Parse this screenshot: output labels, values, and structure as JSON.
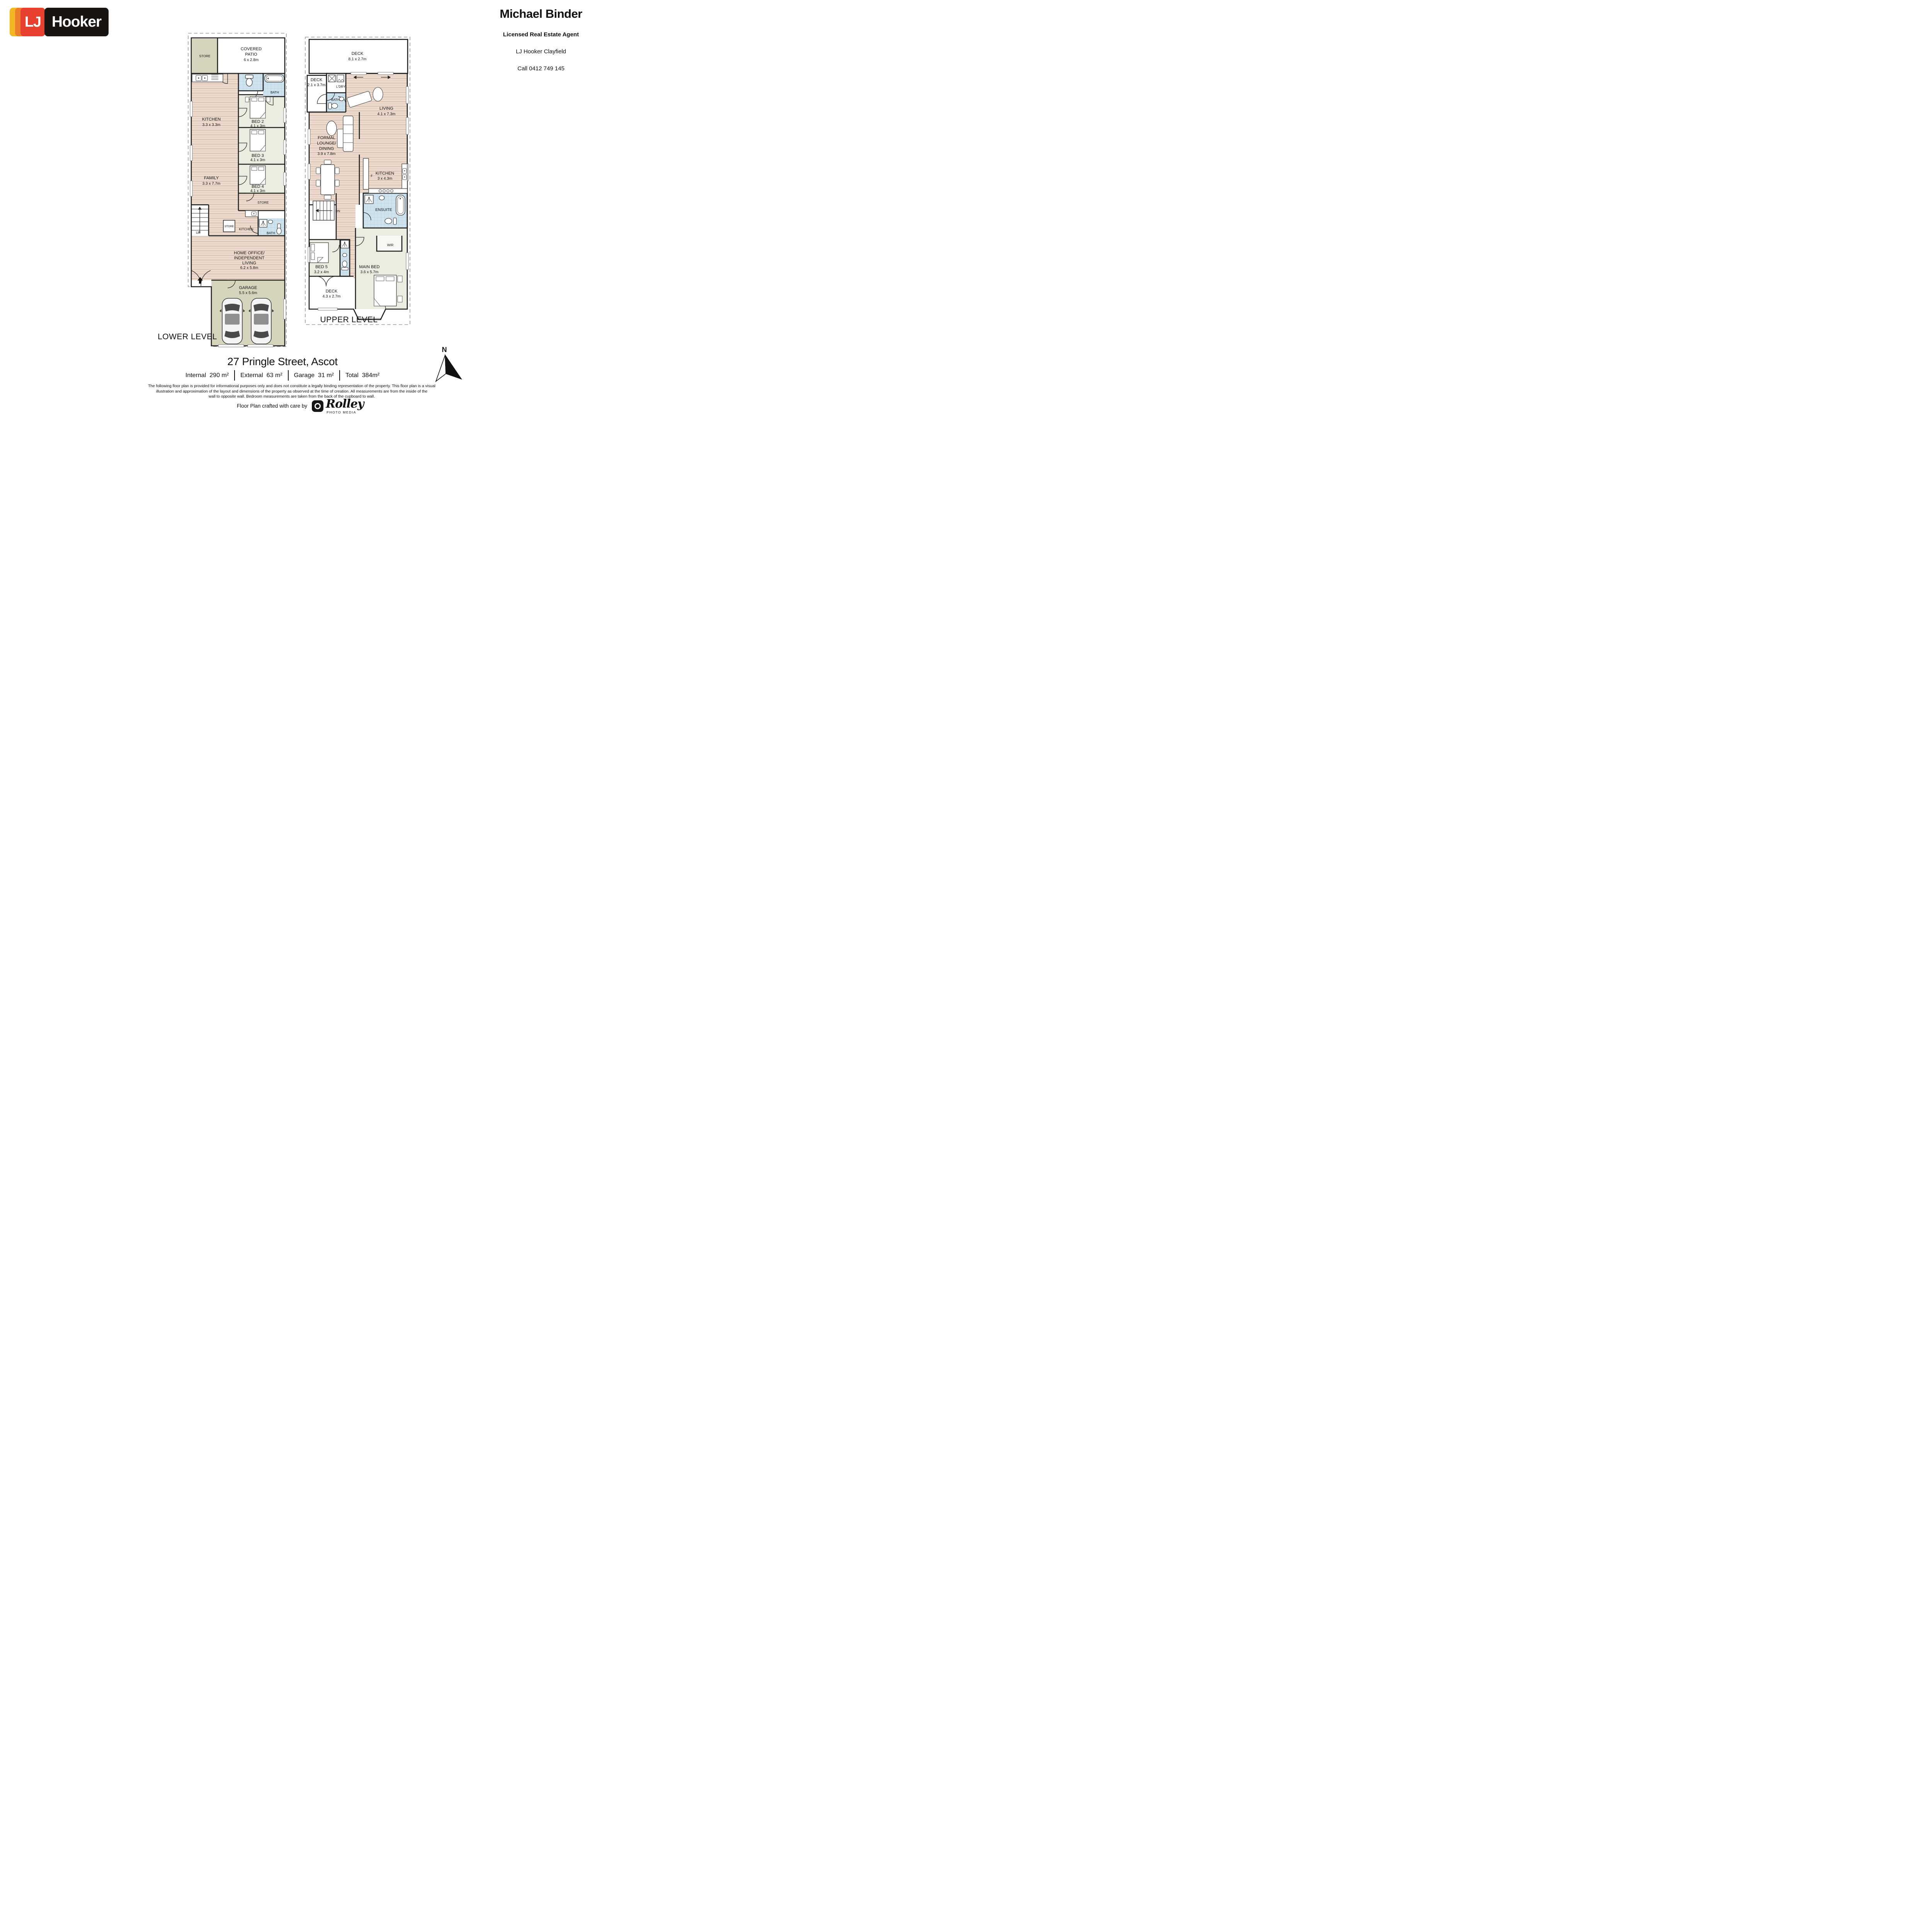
{
  "brand": {
    "lj": "LJ",
    "hooker": "Hooker"
  },
  "agent": {
    "name": "Michael Binder",
    "title": "Licensed Real Estate Agent",
    "office": "LJ Hooker Clayfield",
    "phone": "Call 0412 749 145"
  },
  "plans": {
    "lower": {
      "title": "LOWER LEVEL",
      "rooms": {
        "store_top": {
          "label": "STORE"
        },
        "covered_patio": {
          "l1": "COVERED",
          "l2": "PATIO",
          "dims": "6 x 2.8m"
        },
        "kitchen": {
          "label": "KITCHEN",
          "dims": "3.3 x 3.3m"
        },
        "bath_top": {
          "label": "BATH"
        },
        "bed2": {
          "label": "BED 2",
          "dims": "4.1 x 3m"
        },
        "family": {
          "label": "FAMILY",
          "dims": "3.3 x 7.7m"
        },
        "bed3": {
          "label": "BED 3",
          "dims": "4.1 x 3m"
        },
        "bed4": {
          "label": "BED 4",
          "dims": "4.1 x 3m"
        },
        "store_mid": {
          "label": "STORE"
        },
        "stairs": {
          "label": "UP"
        },
        "store_small": {
          "label": "STORE"
        },
        "kitchenette": {
          "label": "KITCHEN"
        },
        "bath_lower": {
          "label": "BATH"
        },
        "home_office": {
          "l1": "HOME OFFICE/",
          "l2": "INDEPENDENT",
          "l3": "LIVING",
          "dims": "6.2 x 5.8m"
        },
        "garage": {
          "label": "GARAGE",
          "dims": "5.5 x 5.6m"
        }
      }
    },
    "upper": {
      "title": "UPPER LEVEL",
      "rooms": {
        "deck_top": {
          "label": "DECK",
          "dims": "8.1 x 2.7m"
        },
        "deck_left": {
          "label": "DECK",
          "dims": "2.1 x 3.7m"
        },
        "laundry": {
          "label": "L'DRY"
        },
        "bath": {
          "label": "BATH"
        },
        "living": {
          "label": "LIVING",
          "dims": "4.1 x 7.3m"
        },
        "formal": {
          "l1": "FORMAL",
          "l2": "LOUNGE/",
          "l3": "DINING",
          "dims": "3.9 x 7.8m"
        },
        "kitchen": {
          "label": "KITCHEN",
          "dims": "3 x 4.3m",
          "fridge": "F"
        },
        "stairs": {
          "label": "DN"
        },
        "ensuite": {
          "label": "ENSUITE"
        },
        "wir": {
          "label": "WIR"
        },
        "bed5": {
          "label": "BED 5",
          "dims": "3.2 x 4m"
        },
        "main_bed": {
          "label": "MAIN BED",
          "dims": "3.6 x 5.7m"
        },
        "deck_bottom": {
          "label": "DECK",
          "dims": "4.3 x 2.7m"
        }
      }
    }
  },
  "compass": {
    "label": "N"
  },
  "footer": {
    "address": "27 Pringle Street, Ascot",
    "areas": [
      {
        "label": "Internal",
        "value": "290 m²"
      },
      {
        "label": "External",
        "value": "63 m²"
      },
      {
        "label": "Garage",
        "value": "31 m²"
      },
      {
        "label": "Total",
        "value": "384m²"
      }
    ],
    "disclaimer_lines": [
      "The following floor plan is provided for informational purposes only and does not constitute a legally binding representation of the property. This floor plan is a visual",
      "illustration and approximation of the layout and dimensions of the property as observed at the time of creation. All measurements are from the inside of the",
      "wall to opposite wall. Bedroom measurements are taken from the back of the cupboard to wall."
    ],
    "credit": "Floor Plan crafted with care by",
    "rolley": {
      "name": "Rolley",
      "sub": "PHOTO MEDIA"
    }
  }
}
